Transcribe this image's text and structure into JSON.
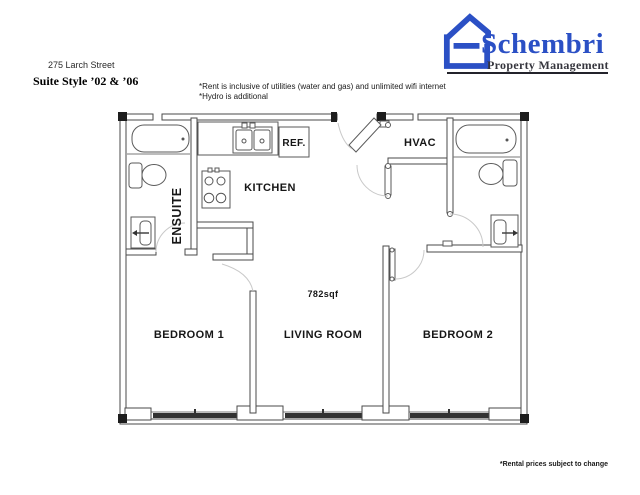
{
  "header": {
    "address": "275 Larch Street",
    "suite_style": "Suite Style ’02 & ’06",
    "notes": [
      "*Rent is inclusive of utilities (water and gas) and unlimited wifi internet",
      "*Hydro is additional"
    ],
    "logo": {
      "name": "Schembri",
      "tagline": "Property Management"
    }
  },
  "floor_plan": {
    "rooms": {
      "ensuite": "ENSUITE",
      "kitchen": "KITCHEN",
      "hvac": "HVAC",
      "bedroom1": "BEDROOM 1",
      "living_room": "LIVING ROOM",
      "bedroom2": "BEDROOM 2"
    },
    "fixtures": {
      "refrigerator": "REF."
    },
    "area_label": "782sqf"
  },
  "footer": {
    "disclaimer": "*Rental prices subject to change"
  },
  "colors": {
    "brand_blue": "#2b50c5",
    "wall_line": "#4a4a4a",
    "window_fill": "#2e2e2e"
  }
}
